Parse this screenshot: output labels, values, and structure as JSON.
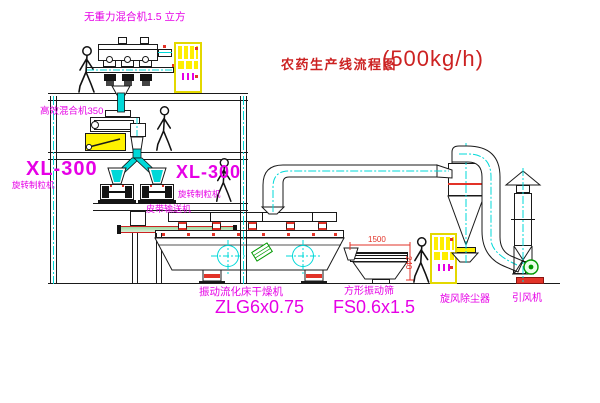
{
  "title": {
    "name": "农药生产线流程图",
    "capacity": "(500kg/h)"
  },
  "labels": {
    "top_mixer": "无重力混合机1.5 立方",
    "second_mixer": "高效混合机350",
    "granulator_left_model": "XL-300",
    "granulator_left_name": "旋转制粒机",
    "granulator_right_model": "XL-300",
    "granulator_right_name": "旋转制粒机",
    "belt_conveyor": "皮带输送机",
    "dryer_name": "振动流化床干燥机",
    "dryer_model": "ZLG6x0.75",
    "screen_name": "方形振动筛",
    "screen_model": "FS0.6x1.5",
    "cyclone": "旋风除尘器",
    "fan": "引风机"
  },
  "dimensions": {
    "screen_length": "1500",
    "screen_height": "240"
  },
  "colors": {
    "label_magenta": "#e600e6",
    "title_red": "#cc2222",
    "accent_red": "#e23328",
    "pipe_cyan": "#00d8d8",
    "highlight_yellow": "#fff200",
    "machine_green": "#009900",
    "line_black": "#1a1a1a"
  }
}
